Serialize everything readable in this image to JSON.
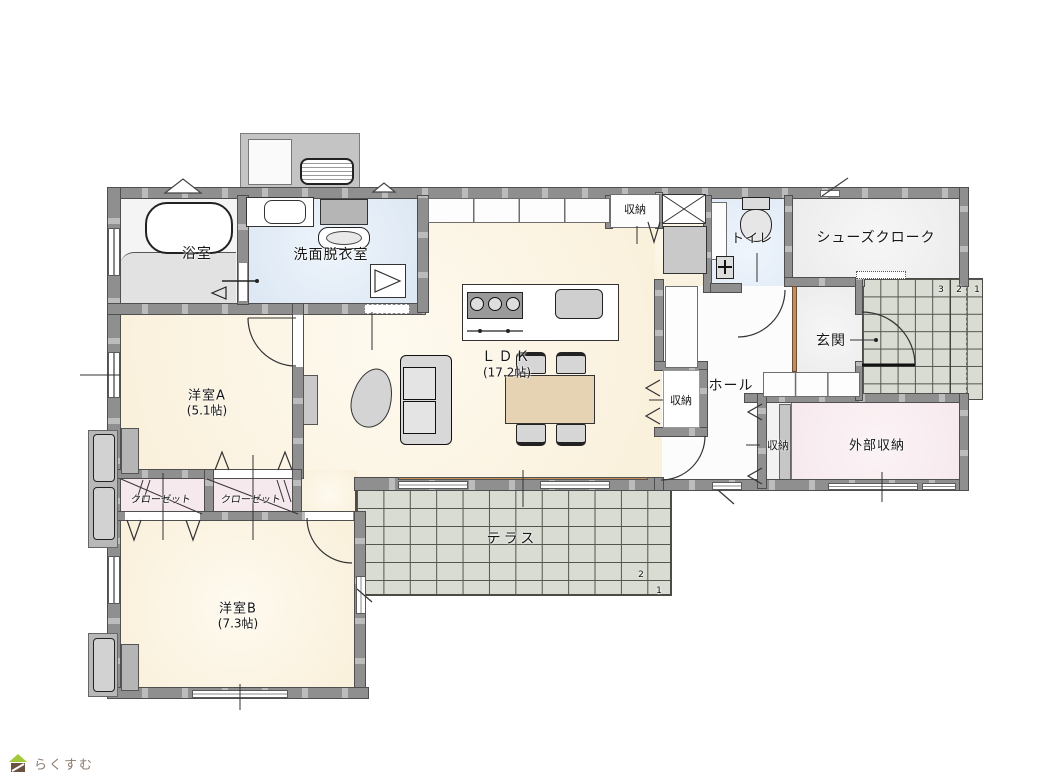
{
  "title": "一戸建て間取り図（平面図）",
  "labels": {
    "bathroom": "浴室",
    "washroom": "洗面脱衣室",
    "storage_top": "収納",
    "toilet": "トイレ",
    "shoe_closet": "シューズクローク",
    "entrance": "玄関",
    "hall": "ホール",
    "storage_hall": "収納",
    "storage_lower": "収納",
    "external_storage": "外部収納",
    "room_a": "洋室A",
    "room_a_area": "(5.1帖)",
    "ldk": "ＬＤＫ",
    "ldk_area": "(17.2帖)",
    "closet_1": "クローゼット",
    "closet_2": "クローゼット",
    "room_b": "洋室B",
    "room_b_area": "(7.3帖)",
    "terrace": "テラス"
  },
  "steps": {
    "porch": [
      "3",
      "2",
      "1"
    ],
    "terrace": [
      "2",
      "1"
    ]
  },
  "logo": {
    "text": "らくすむ"
  },
  "colors": {
    "floor": "#faf1dd",
    "washroom": "#dde8f4",
    "toilet": "#e2ebf7",
    "closet": "#f6e9ed",
    "external_storage": "#f7eaee",
    "entrance": "#ededed",
    "tile": "#d9dcd3",
    "wall": "#8f8f8f",
    "wood": "#c09058",
    "logo_green": "#a3c93a",
    "logo_brown": "#6b5140",
    "text": "#8b7a6c"
  }
}
